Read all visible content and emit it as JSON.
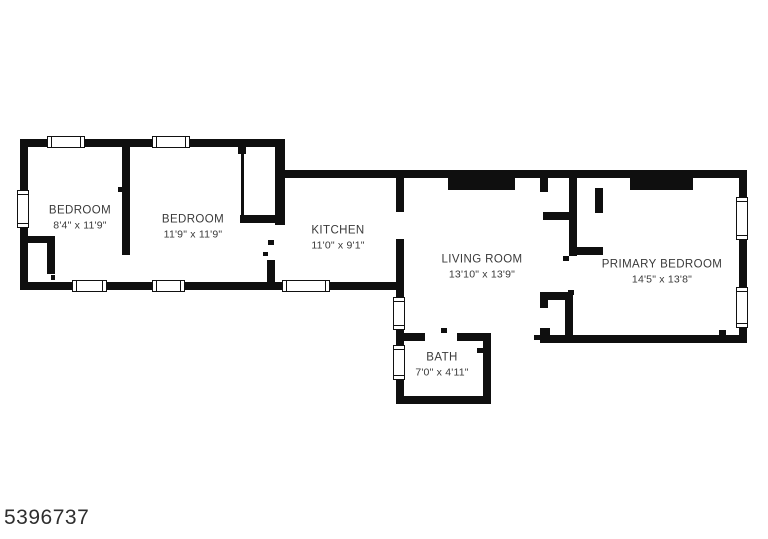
{
  "plan_number": "5396737",
  "colors": {
    "wall": "#0f0f0f",
    "label_text": "#3a3a3a",
    "background": "#ffffff"
  },
  "rooms": [
    {
      "id": "bedroom-1",
      "name": "BEDROOM",
      "dims": "8'4\" x 11'9\"",
      "cx": 80,
      "cy": 218
    },
    {
      "id": "bedroom-2",
      "name": "BEDROOM",
      "dims": "11'9\" x 11'9\"",
      "cx": 193,
      "cy": 227
    },
    {
      "id": "kitchen",
      "name": "KITCHEN",
      "dims": "11'0\" x 9'1\"",
      "cx": 338,
      "cy": 238
    },
    {
      "id": "living-room",
      "name": "LIVING ROOM",
      "dims": "13'10\" x 13'9\"",
      "cx": 482,
      "cy": 267
    },
    {
      "id": "primary-bedroom",
      "name": "PRIMARY BEDROOM",
      "dims": "14'5\" x 13'8\"",
      "cx": 662,
      "cy": 272
    },
    {
      "id": "bath",
      "name": "BATH",
      "dims": "7'0\" x 4'11\"",
      "cx": 442,
      "cy": 365
    }
  ],
  "floorplan": {
    "walls": [
      [
        20,
        139,
        265,
        8
      ],
      [
        20,
        139,
        8,
        151
      ],
      [
        20,
        282,
        384,
        8
      ],
      [
        20,
        236,
        35,
        7
      ],
      [
        47,
        243,
        8,
        31
      ],
      [
        122,
        147,
        8,
        103
      ],
      [
        122,
        250,
        8,
        5
      ],
      [
        238,
        147,
        8,
        7
      ],
      [
        241,
        150,
        3,
        65
      ],
      [
        240,
        215,
        45,
        8
      ],
      [
        275,
        139,
        10,
        86
      ],
      [
        267,
        260,
        8,
        30
      ],
      [
        275,
        170,
        472,
        8
      ],
      [
        396,
        178,
        8,
        34
      ],
      [
        396,
        239,
        8,
        6
      ],
      [
        396,
        245,
        8,
        52
      ],
      [
        396,
        330,
        8,
        15
      ],
      [
        396,
        380,
        8,
        24
      ],
      [
        396,
        396,
        95,
        8
      ],
      [
        483,
        333,
        8,
        71
      ],
      [
        404,
        333,
        21,
        8
      ],
      [
        457,
        333,
        34,
        8
      ],
      [
        540,
        335,
        207,
        8
      ],
      [
        739,
        170,
        8,
        173
      ],
      [
        448,
        178,
        67,
        12
      ],
      [
        630,
        178,
        63,
        12
      ],
      [
        540,
        178,
        8,
        14
      ],
      [
        569,
        178,
        8,
        78
      ],
      [
        543,
        212,
        26,
        8
      ],
      [
        595,
        188,
        8,
        25
      ],
      [
        570,
        247,
        33,
        8
      ],
      [
        540,
        292,
        33,
        8
      ],
      [
        540,
        292,
        8,
        16
      ],
      [
        565,
        300,
        8,
        37
      ],
      [
        540,
        328,
        10,
        8
      ]
    ],
    "windows": [
      {
        "x": 47,
        "y": 136,
        "w": 38,
        "h": 12,
        "dir": "h"
      },
      {
        "x": 152,
        "y": 136,
        "w": 38,
        "h": 12,
        "dir": "h"
      },
      {
        "x": 17,
        "y": 190,
        "w": 12,
        "h": 38,
        "dir": "v"
      },
      {
        "x": 72,
        "y": 280,
        "w": 35,
        "h": 12,
        "dir": "h"
      },
      {
        "x": 152,
        "y": 280,
        "w": 33,
        "h": 12,
        "dir": "h"
      },
      {
        "x": 282,
        "y": 280,
        "w": 48,
        "h": 12,
        "dir": "h"
      },
      {
        "x": 393,
        "y": 297,
        "w": 12,
        "h": 33,
        "dir": "v"
      },
      {
        "x": 393,
        "y": 345,
        "w": 12,
        "h": 35,
        "dir": "v"
      },
      {
        "x": 736,
        "y": 197,
        "w": 12,
        "h": 43,
        "dir": "v"
      },
      {
        "x": 736,
        "y": 287,
        "w": 12,
        "h": 41,
        "dir": "v"
      }
    ],
    "door_ticks": [
      [
        51,
        275,
        4,
        5
      ],
      [
        118,
        187,
        5,
        5
      ],
      [
        268,
        240,
        6,
        5
      ],
      [
        263,
        252,
        5,
        4
      ],
      [
        441,
        328,
        6,
        5
      ],
      [
        477,
        348,
        6,
        5
      ],
      [
        534,
        335,
        6,
        5
      ],
      [
        719,
        330,
        7,
        5
      ],
      [
        563,
        256,
        6,
        5
      ],
      [
        568,
        290,
        6,
        5
      ]
    ]
  }
}
